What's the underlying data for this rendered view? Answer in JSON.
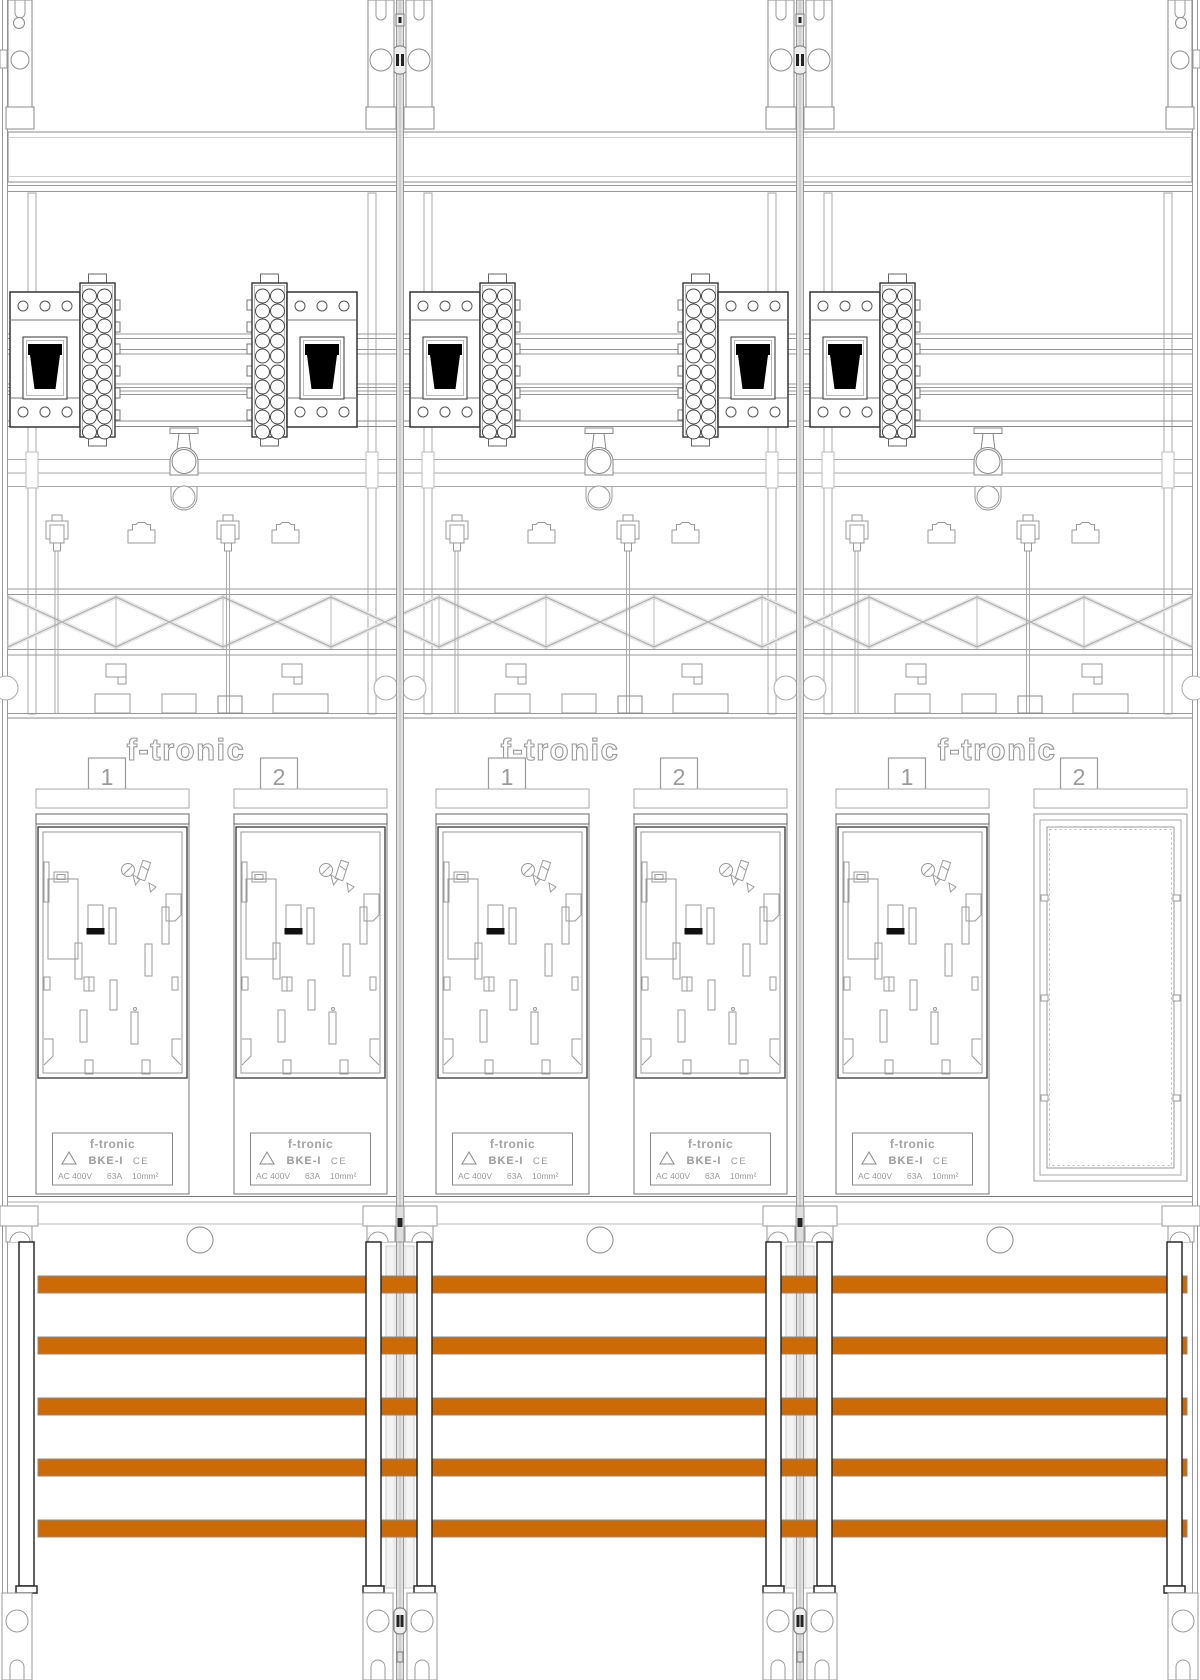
{
  "cabinet": {
    "panels": [
      {
        "logo": "f-tronic",
        "positions": [
          {
            "number": "1"
          },
          {
            "number": "2"
          }
        ]
      },
      {
        "logo": "f-tronic",
        "positions": [
          {
            "number": "1"
          },
          {
            "number": "2"
          }
        ]
      },
      {
        "logo": "f-tronic",
        "positions": [
          {
            "number": "1"
          },
          {
            "number": "2"
          }
        ]
      }
    ]
  },
  "meter_label": {
    "brand": "f-tronic",
    "model": "BKE-I",
    "ce_mark": "CE",
    "specs": {
      "voltage": "AC 400V",
      "current": "63A",
      "cross_section": "10mm²"
    }
  },
  "busbars": {
    "count": 5,
    "color": "#cc6a05"
  }
}
